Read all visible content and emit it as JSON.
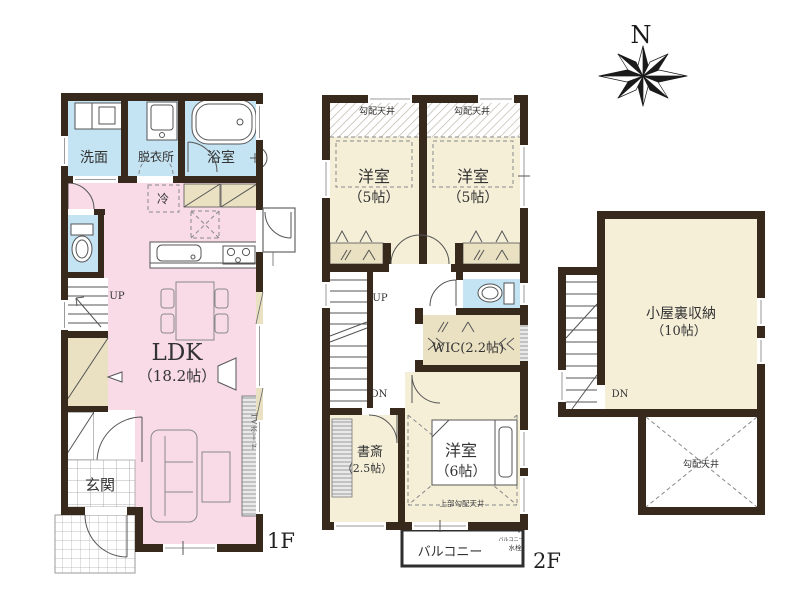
{
  "colors": {
    "wall": "#38291d",
    "ldk_pink": "#f8dbe7",
    "wet_blue": "#c4e4f3",
    "room_cream": "#f5efd8",
    "closet_beige": "#eae0c2"
  },
  "floor1": {
    "label": "1F",
    "washroom": "洗面",
    "dressing_room": "脱衣所",
    "bathroom": "浴室",
    "fridge": "冷",
    "ldk_name": "LDK",
    "ldk_size": "（18.2帖）",
    "stairs_up": "UP",
    "entrance": "玄関",
    "tv_board": "TVボード"
  },
  "floor2": {
    "label": "2F",
    "sloped_ceiling_left": "勾配天井",
    "sloped_ceiling_right": "勾配天井",
    "bedroom_left_name": "洋室",
    "bedroom_left_size": "（5帖）",
    "bedroom_right_name": "洋室",
    "bedroom_right_size": "（5帖）",
    "stairs_up": "UP",
    "stairs_down": "DN",
    "wic": "WIC(2.2帖)",
    "study_name": "書斎",
    "study_size": "（2.5帖）",
    "bedroom6_name": "洋室",
    "bedroom6_size": "（6帖）",
    "upper_sloped_ceiling": "上部勾配天井",
    "balcony": "バルコニー",
    "balcony_tap_line1": "バルコニー",
    "balcony_tap_line2": "水栓"
  },
  "attic": {
    "storage_name": "小屋裏収納",
    "storage_size": "（10帖）",
    "stairs_down": "DN",
    "sloped_ceiling": "勾配天井"
  },
  "compass": {
    "north_label": "N"
  }
}
